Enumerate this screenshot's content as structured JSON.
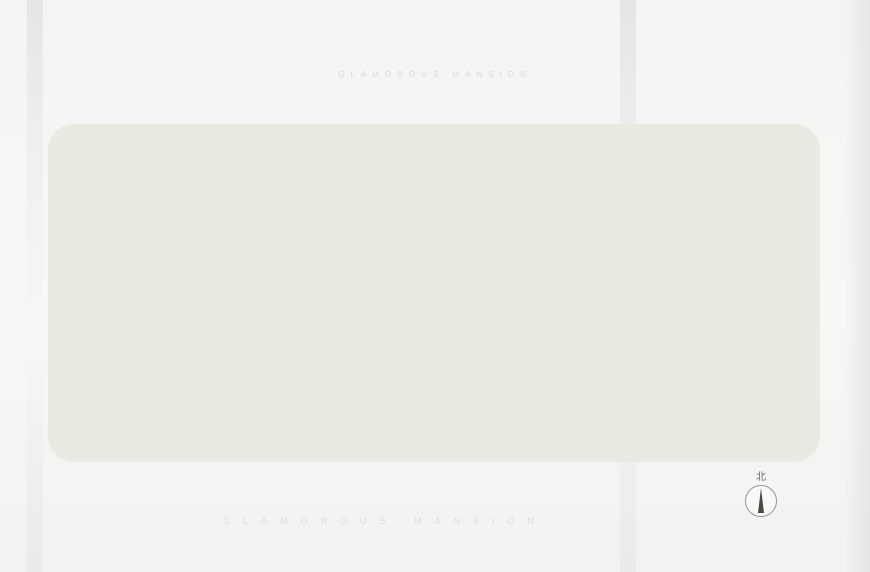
{
  "page": {
    "title": "项目总平图",
    "title_subtitle": "GLAMOROUS MANSION",
    "watermark": "GLAMOROUS MANSION",
    "compass_label": "北"
  },
  "legend": {
    "items": [
      {
        "num": "01",
        "label": "知风花园"
      },
      {
        "num": "02",
        "label": "观风泳池"
      },
      {
        "num": "03",
        "label": "阳光绿坪"
      },
      {
        "num": "04",
        "label": "扶风会客厅"
      },
      {
        "num": "05",
        "label": "逐风乐园"
      },
      {
        "num": "06",
        "label": "康健广场"
      },
      {
        "num": "07",
        "label": "健身空间"
      }
    ]
  },
  "plan": {
    "zones": {
      "commercial": "社区商业",
      "public": "公建配套"
    },
    "entrances": [
      {
        "id": "top-fire",
        "label": "消防出入口"
      },
      {
        "id": "top-main",
        "label": "主入口"
      },
      {
        "id": "left-side",
        "label": "次入口"
      },
      {
        "id": "bottom-fire",
        "label": "消防出入口"
      },
      {
        "id": "bottom-side",
        "label": "次入口"
      },
      {
        "id": "garage-south",
        "label": "地下车库出入口"
      },
      {
        "id": "garage-west",
        "label": "地下车库出入口"
      },
      {
        "id": "garage-north",
        "label": "地下车库入口"
      }
    ],
    "road_label": "城市道路",
    "clusters": [
      {
        "id": "c1",
        "buildings": [
          "1栋",
          "2栋"
        ],
        "top_units": [
          "03",
          "04",
          "04",
          "03"
        ],
        "bottom_units": [
          "02",
          "01",
          "01",
          "02"
        ],
        "aux": [
          "配电房"
        ]
      },
      {
        "id": "c2",
        "buildings": [
          "3栋",
          "5栋"
        ],
        "top_units": [
          "02",
          "03",
          "03",
          "02"
        ],
        "bottom_units": [
          "01",
          "01"
        ],
        "aux": []
      },
      {
        "id": "c3",
        "buildings": [
          "6栋",
          "7栋"
        ],
        "top_units": [
          "03",
          "04",
          "04",
          "03"
        ],
        "bottom_units": [
          "02",
          "01",
          "01",
          "02"
        ],
        "aux": [
          "配电房"
        ]
      },
      {
        "id": "c4",
        "buildings": [
          "13栋",
          "12栋"
        ],
        "top_units": [
          "03",
          "04",
          "04",
          "03"
        ],
        "bottom_units": [
          "02",
          "01",
          "01",
          "02"
        ],
        "aux": [
          "配电房",
          "换热房"
        ]
      },
      {
        "id": "c5",
        "buildings": [
          "11栋",
          "10栋"
        ],
        "top_units": [
          "02",
          "03",
          "03",
          "02"
        ],
        "bottom_units": [
          "01",
          "01"
        ],
        "aux": [
          "配电房",
          "自行车停车区"
        ]
      },
      {
        "id": "c6",
        "buildings": [
          "9栋",
          "8栋"
        ],
        "top_units": [
          "03",
          "04",
          "04",
          "03"
        ],
        "bottom_units": [
          "02",
          "01",
          "01",
          "02"
        ],
        "aux": [
          "配电房",
          "自行车停车场"
        ]
      }
    ],
    "amenity_markers": [
      "01",
      "02",
      "03",
      "04",
      "05",
      "06",
      "07"
    ]
  }
}
